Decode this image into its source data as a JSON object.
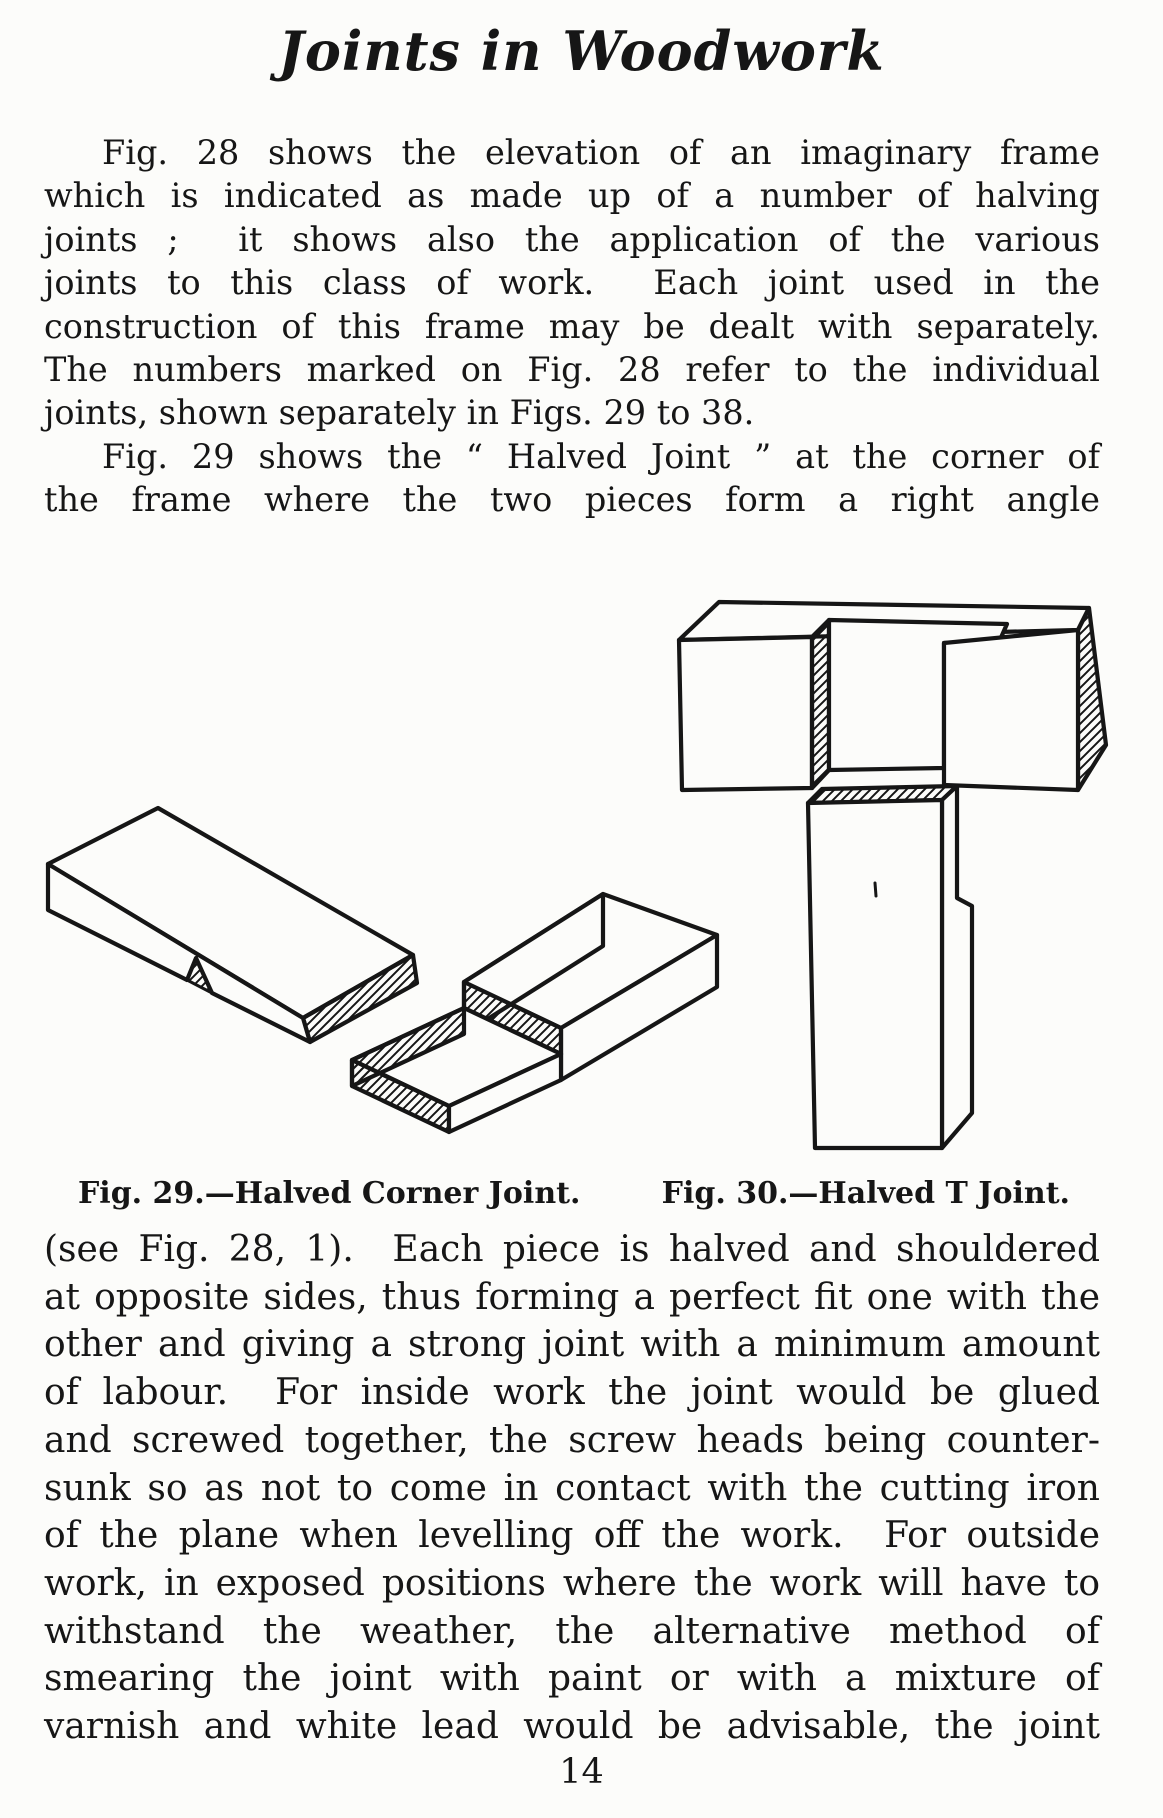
{
  "page": {
    "title": "Joints in Woodwork",
    "page_number": "14",
    "paper_color": "#fcfcfa",
    "ink_color": "#161616"
  },
  "body": {
    "top_lines": [
      {
        "t": "Fig. 28 shows the elevation of an imaginary frame",
        "indent": true
      },
      {
        "t": "which is indicated as made up of a number of halving"
      },
      {
        "t": "joints ;  it shows also the application of the various"
      },
      {
        "t": "joints to this class of work.  Each joint used in the"
      },
      {
        "t": "construction of this frame may be dealt with separately."
      },
      {
        "t": "The numbers marked on Fig. 28 refer to the individual"
      },
      {
        "t": "joints, shown separately in Figs. 29 to 38.",
        "last": true
      },
      {
        "t": "Fig. 29 shows the “ Halved Joint ” at the corner of",
        "indent": true
      },
      {
        "t": "the frame where the two pieces form a right angle"
      }
    ],
    "bottom_lines": [
      {
        "t": "(see Fig. 28, 1).  Each piece is halved and shouldered"
      },
      {
        "t": "at opposite sides, thus forming a perfect fit one with the"
      },
      {
        "t": "other and giving a strong joint with a minimum amount"
      },
      {
        "t": "of labour.  For inside work the joint would be glued"
      },
      {
        "t": "and screwed together, the screw heads being counter-"
      },
      {
        "t": "sunk so as not to come in contact with the cutting iron"
      },
      {
        "t": "of the plane when levelling off the work.  For outside"
      },
      {
        "t": "work, in exposed positions where the work will have to"
      },
      {
        "t": "withstand the weather, the alternative method of"
      },
      {
        "t": "smearing the joint with paint or with a mixture of"
      },
      {
        "t": "varnish and white lead would be advisable, the joint"
      }
    ]
  },
  "figures": {
    "caption_fig29": "Fig. 29.—Halved Corner Joint.",
    "caption_fig30": "Fig. 30.—Halved T Joint."
  }
}
